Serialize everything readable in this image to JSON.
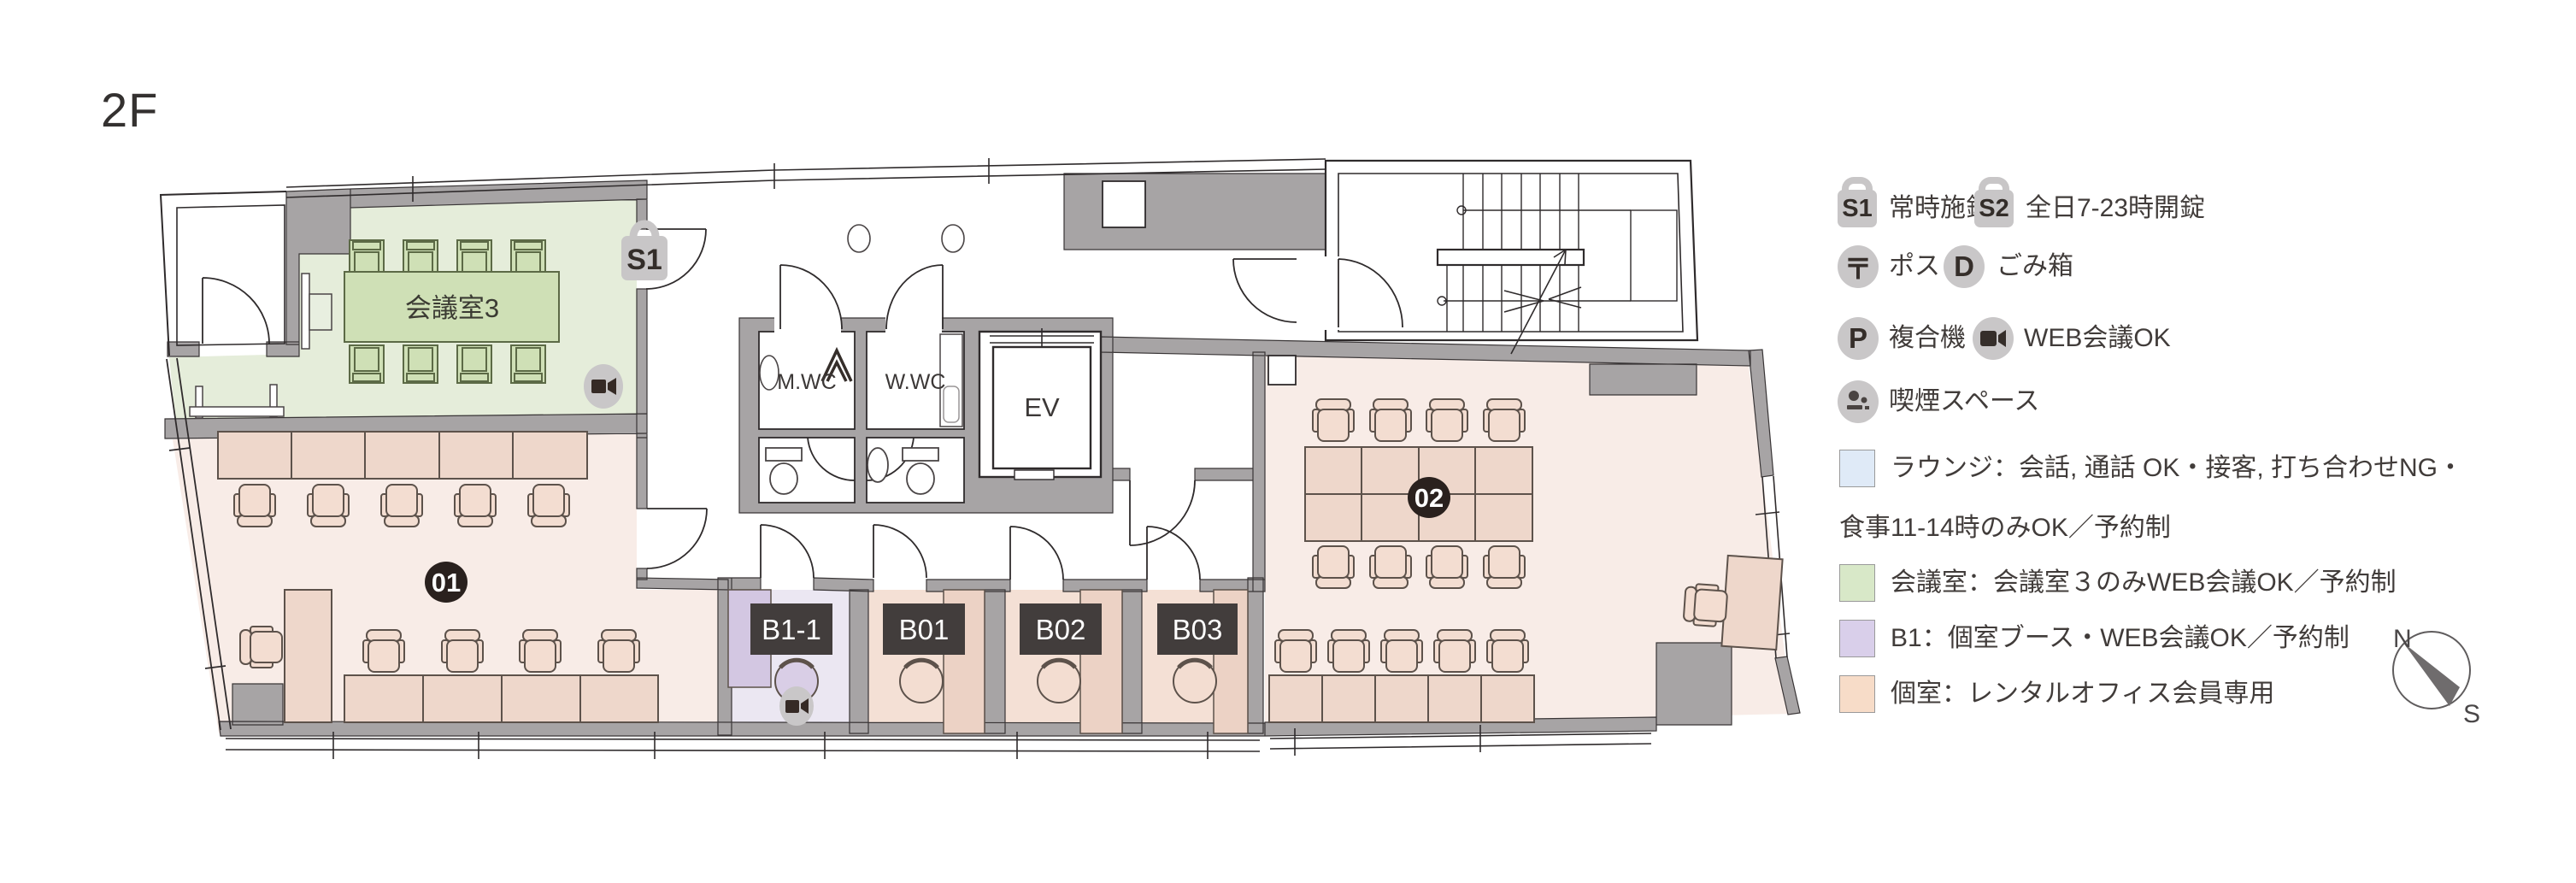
{
  "title": "2F",
  "plan": {
    "meeting_room_label": "会議室3",
    "badge_s1": "S1",
    "room01_badge": "01",
    "room02_badge": "02",
    "mwc_label": "M.WC",
    "wwc_label": "W.WC",
    "ev_label": "EV",
    "booth_b11": "B1-1",
    "booth_b01": "B01",
    "booth_b02": "B02",
    "booth_b03": "B03"
  },
  "legend": {
    "locks": [
      {
        "badge": "S1",
        "label": "常時施錠"
      },
      {
        "badge": "S2",
        "label": "全日7-23時開錠"
      }
    ],
    "facilities": [
      {
        "glyph": "〒",
        "label": "ポスト"
      },
      {
        "glyph": "D",
        "label": "ごみ箱"
      },
      {
        "glyph": "P",
        "label": "複合機"
      },
      {
        "icon": "web-camera",
        "label": "WEB会議OK"
      },
      {
        "icon": "smoking",
        "label": "喫煙スペース"
      }
    ],
    "zones": [
      {
        "color": "#dfeaf7",
        "label": "ラウンジ：会話, 通話 OK・接客, 打ち合わせNG・",
        "label2": "食事11-14時のみOK／予約制"
      },
      {
        "color": "#d8e8c8",
        "label": "会議室：会議室３のみWEB会議OK／予約制"
      },
      {
        "color": "#d9cfea",
        "label": "B1：個室ブース・WEB会議OK／予約制"
      },
      {
        "color": "#f7dcc8",
        "label": "個室：レンタルオフィス会員専用"
      }
    ],
    "compass": {
      "n": "N",
      "s": "S"
    }
  },
  "colors": {
    "wall": "#a7a4a5",
    "meeting_room": "#e5edda",
    "private_room": "#f8ece7",
    "booth_room": "#ebe7f2",
    "plate": "#423d3c",
    "badge": "#2a211e",
    "icon_bg": "#c9c7c8"
  }
}
